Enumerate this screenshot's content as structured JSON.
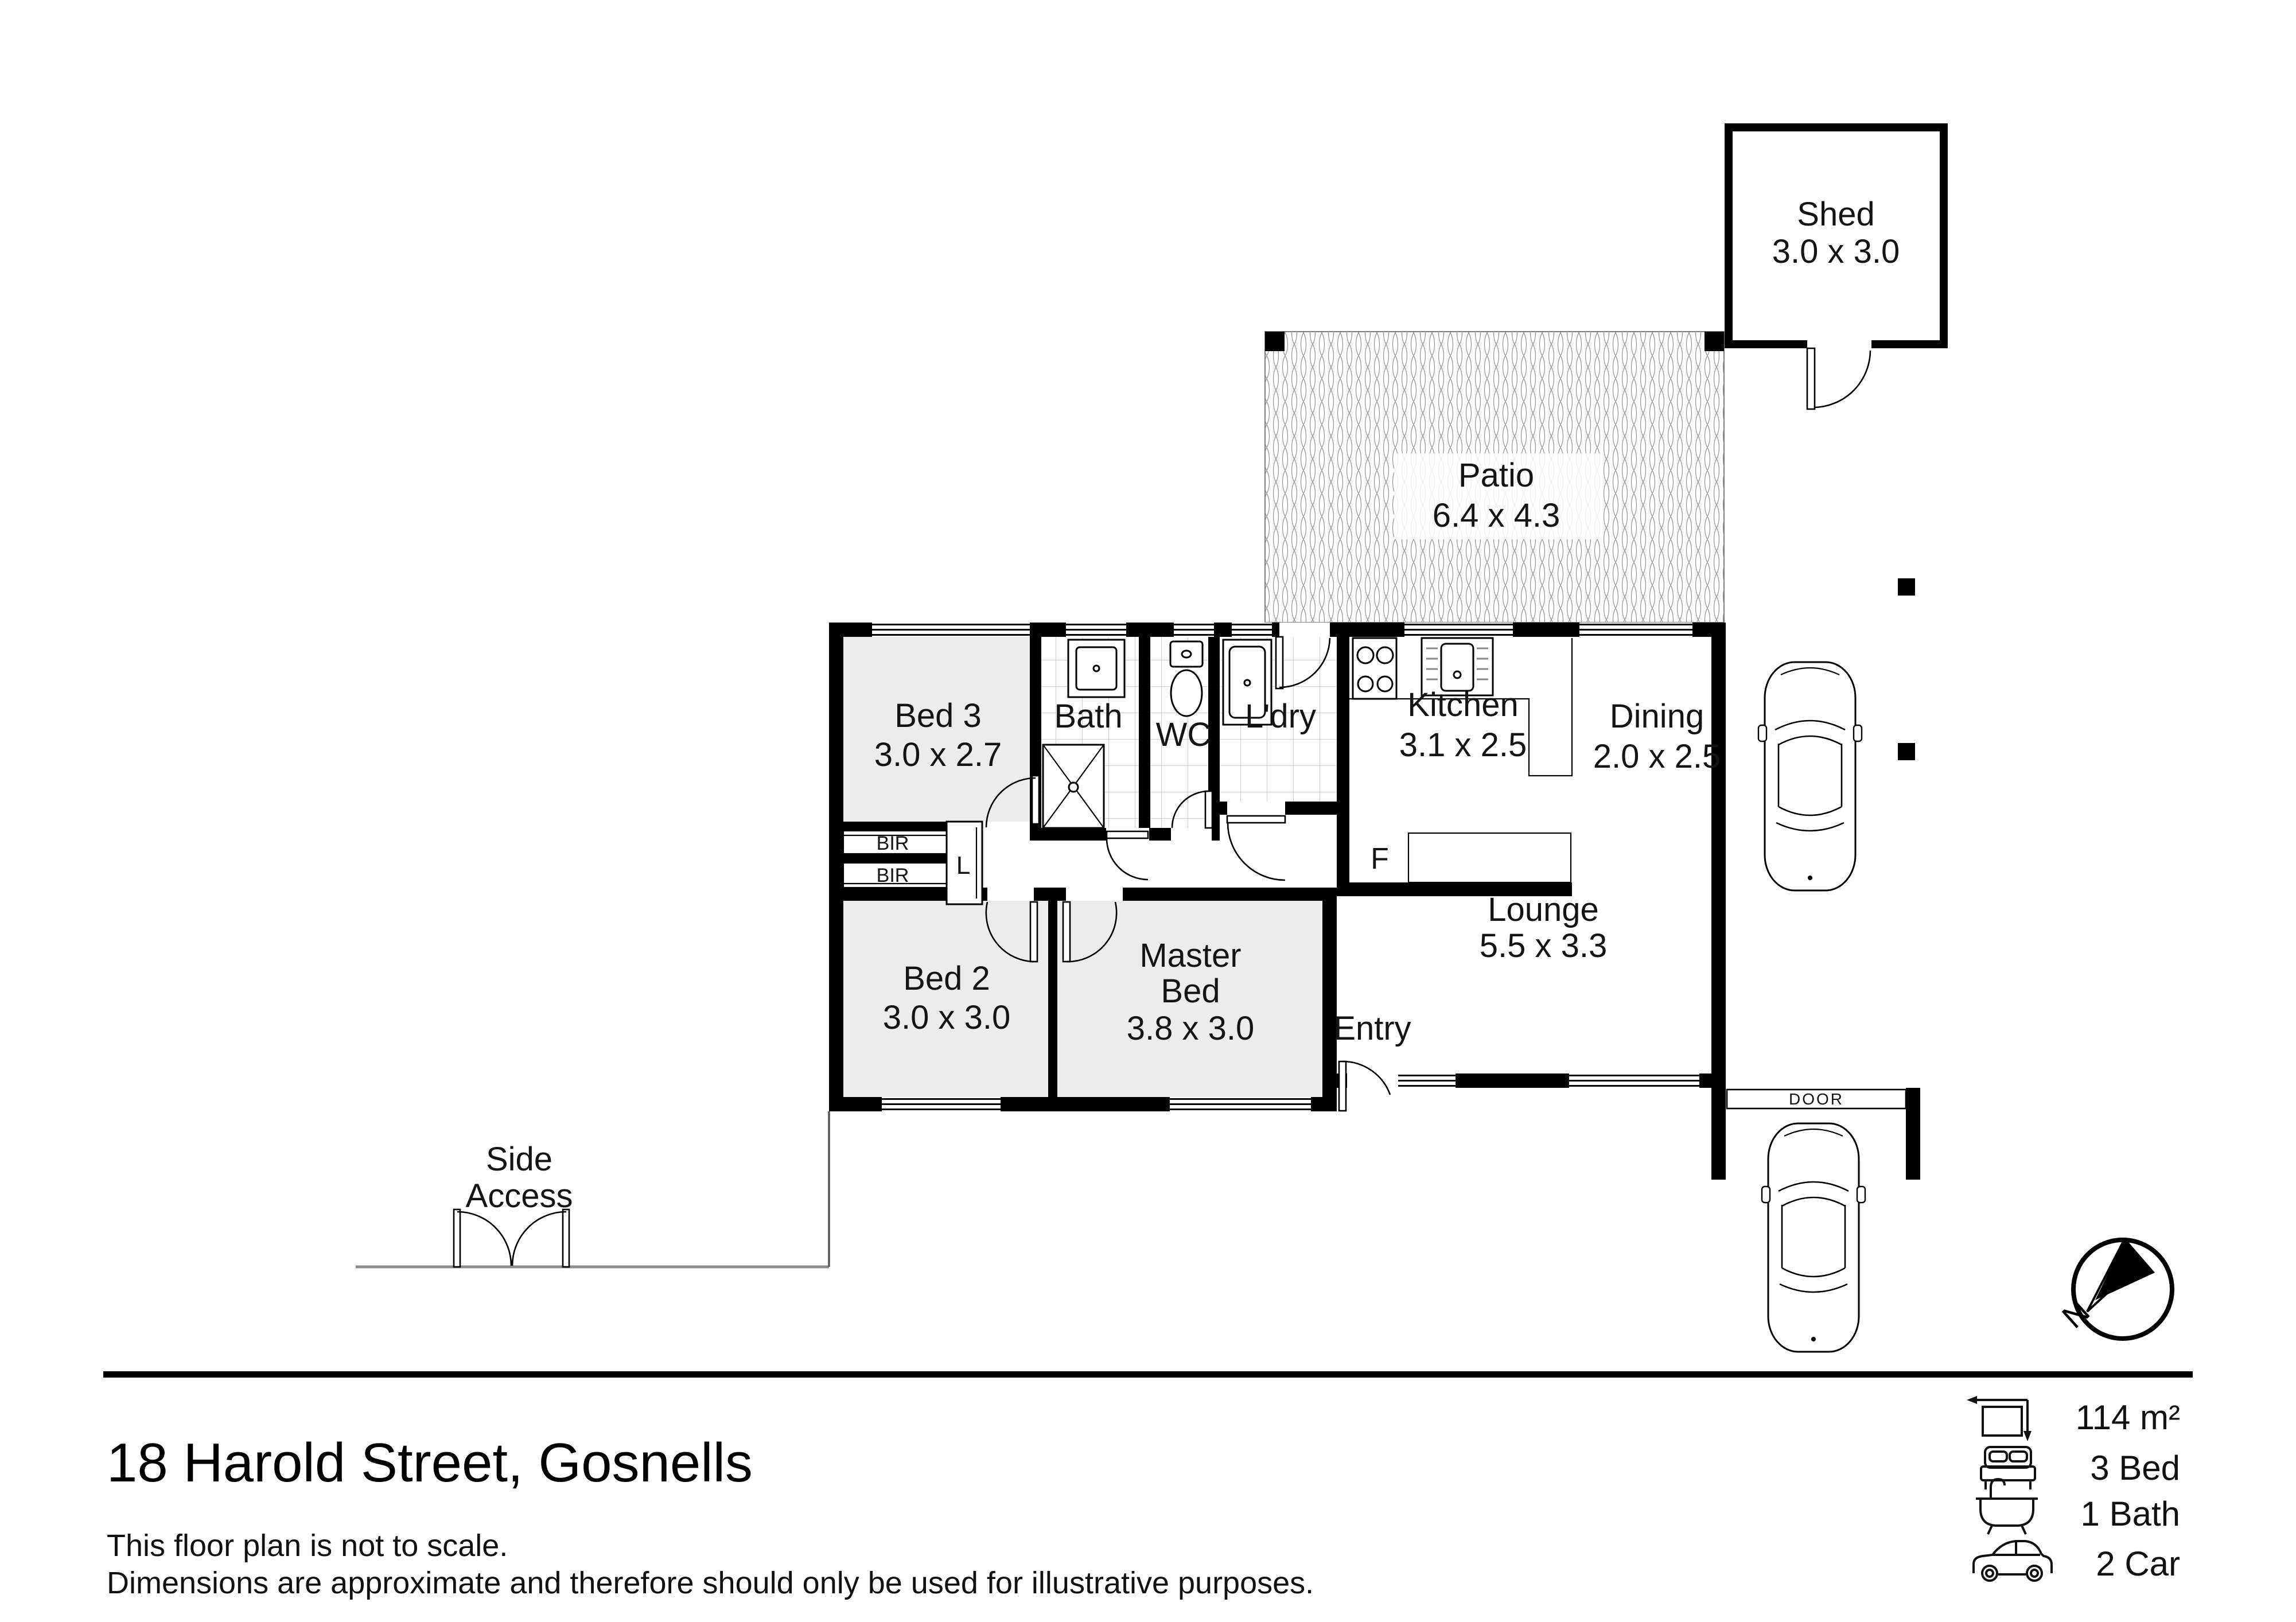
{
  "plan": {
    "rooms": {
      "shed": {
        "name": "Shed",
        "dims": "3.0 x 3.0"
      },
      "patio": {
        "name": "Patio",
        "dims": "6.4 x 4.3"
      },
      "bed3": {
        "name": "Bed 3",
        "dims": "3.0 x 2.7"
      },
      "bath": {
        "name": "Bath"
      },
      "wc": {
        "name": "WC"
      },
      "laundry": {
        "name": "L'dry"
      },
      "kitchen": {
        "name": "Kitchen",
        "dims": "3.1 x 2.5"
      },
      "dining": {
        "name": "Dining",
        "dims": "2.0 x 2.5"
      },
      "lounge": {
        "name": "Lounge",
        "dims": "5.5 x 3.3"
      },
      "bed2": {
        "name": "Bed 2",
        "dims": "3.0 x 3.0"
      },
      "master": {
        "name_line1": "Master",
        "name_line2": "Bed",
        "dims": "3.8 x 3.0"
      },
      "entry": {
        "name": "Entry"
      }
    },
    "annotations": {
      "bir1": "BIR",
      "bir2": "BIR",
      "linen": "L",
      "fridge": "F",
      "garage_door": "DOOR",
      "side_access_line1": "Side",
      "side_access_line2": "Access",
      "compass_north": "N"
    },
    "colors": {
      "wall": "#000000",
      "bedroom_fill": "#ececec",
      "tile_line": "#c4c4c4",
      "patio_hatch": "#999999",
      "boundary": "#8c8c8c"
    }
  },
  "footer": {
    "title": "18 Harold Street, Gosnells",
    "disclaimer_line1": "This floor plan is not to scale.",
    "disclaimer_line2": "Dimensions are approximate and therefore should only be used for illustrative purposes.",
    "stats": [
      {
        "icon": "area-icon",
        "label": "114 m²"
      },
      {
        "icon": "bed-icon",
        "label": "3 Bed"
      },
      {
        "icon": "bath-icon",
        "label": "1 Bath"
      },
      {
        "icon": "car-icon",
        "label": "2 Car"
      }
    ]
  }
}
